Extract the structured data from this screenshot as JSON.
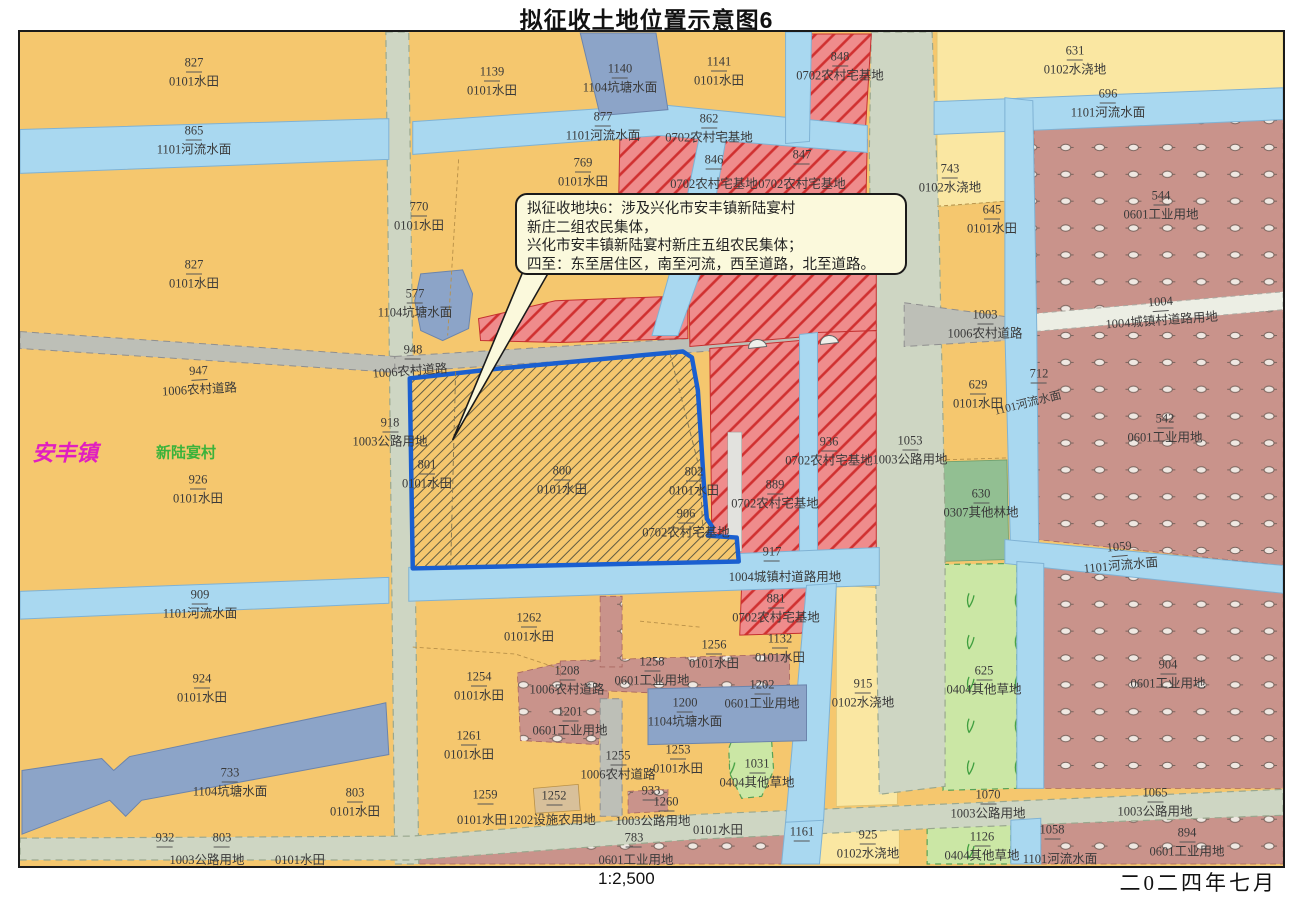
{
  "title": "拟征收土地位置示意图6",
  "scale_label": "1:2,500",
  "date_label": "二0二四年七月",
  "callout": {
    "lines": [
      "拟征收地块6：涉及兴化市安丰镇新陆宴村",
      "新庄二组农民集体，",
      "兴化市安丰镇新陆宴村新庄五组农民集体；",
      "四至：东至居住区，南至河流，西至道路，北至道路。"
    ]
  },
  "palette": {
    "paddy_0101": "#F5C76E",
    "irrigated_0102": "#FAE7A2",
    "river_1101": "#A9D8F0",
    "pond_1104": "#8CA4C8",
    "homestead_0702": "#EF8C8C",
    "homestead_hatch": "#D03030",
    "industrial_0601": "#C9938B",
    "forest_0307": "#92BF92",
    "grass_0404": "#CBE7A5",
    "road_highway_1003": "#CED6C3",
    "road_rural_1006": "#BDBFB7",
    "road_town_1004": "#ECEEE4",
    "facility_1202": "#D8C09A",
    "acquisition_outline": "#1A5FD0",
    "town_label": "#E11FC0",
    "village_label": "#3BB33B",
    "callout_bg": "#FBF9DC"
  },
  "map": {
    "labels": [
      {
        "x": 192,
        "y": 70,
        "n": "827",
        "t": "0101水田"
      },
      {
        "x": 192,
        "y": 138,
        "n": "865",
        "t": "1101河流水面"
      },
      {
        "x": 192,
        "y": 272,
        "n": "827",
        "t": "0101水田"
      },
      {
        "x": 197,
        "y": 378,
        "n": "947",
        "t": "1006农村道路",
        "r": -3
      },
      {
        "x": 63,
        "y": 452,
        "t": "安丰镇",
        "c": "#E11FC0",
        "s": 22,
        "b": 1,
        "i": 1
      },
      {
        "x": 184,
        "y": 452,
        "t": "新陆宴村",
        "c": "#3BB33B",
        "s": 15,
        "b": 1
      },
      {
        "x": 196,
        "y": 487,
        "n": "926",
        "t": "0101水田"
      },
      {
        "x": 198,
        "y": 602,
        "n": "909",
        "t": "1101河流水面"
      },
      {
        "x": 200,
        "y": 686,
        "n": "924",
        "t": "0101水田"
      },
      {
        "x": 228,
        "y": 780,
        "n": "733",
        "t": "1104坑塘水面"
      },
      {
        "x": 353,
        "y": 800,
        "n": "803",
        "t": "0101水田"
      },
      {
        "x": 163,
        "y": 838,
        "n": "932"
      },
      {
        "x": 220,
        "y": 838,
        "n": "803"
      },
      {
        "x": 205,
        "y": 858,
        "t": "1003公路用地"
      },
      {
        "x": 298,
        "y": 858,
        "t": "0101水田"
      },
      {
        "x": 490,
        "y": 79,
        "n": "1139",
        "t": "0101水田"
      },
      {
        "x": 618,
        "y": 76,
        "n": "1140",
        "t": "1104坑塘水面"
      },
      {
        "x": 601,
        "y": 124,
        "n": "877",
        "t": "1101河流水面"
      },
      {
        "x": 581,
        "y": 170,
        "n": "769",
        "t": "0101水田"
      },
      {
        "x": 417,
        "y": 214,
        "n": "770",
        "t": "0101水田"
      },
      {
        "x": 413,
        "y": 301,
        "n": "577",
        "t": "1104坑塘水面"
      },
      {
        "x": 411,
        "y": 350,
        "n": "948"
      },
      {
        "x": 408,
        "y": 369,
        "t": "1006农村道路",
        "r": -4
      },
      {
        "x": 388,
        "y": 430,
        "n": "918",
        "t": "1003公路用地"
      },
      {
        "x": 425,
        "y": 472,
        "n": "801",
        "t": "0101水田"
      },
      {
        "x": 560,
        "y": 478,
        "n": "800",
        "t": "0101水田"
      },
      {
        "x": 692,
        "y": 479,
        "n": "802",
        "t": "0101水田"
      },
      {
        "x": 684,
        "y": 521,
        "n": "906",
        "t": "0702农村宅基地"
      },
      {
        "x": 717,
        "y": 69,
        "n": "1141",
        "t": "0101水田"
      },
      {
        "x": 838,
        "y": 64,
        "n": "848",
        "t": "0702农村宅基地"
      },
      {
        "x": 707,
        "y": 126,
        "n": "862",
        "t": "0702农村宅基地"
      },
      {
        "x": 712,
        "y": 160,
        "n": "846"
      },
      {
        "x": 800,
        "y": 155,
        "n": "847"
      },
      {
        "x": 712,
        "y": 182,
        "t": "0702农村宅基地"
      },
      {
        "x": 800,
        "y": 182,
        "t": "0702农村宅基地"
      },
      {
        "x": 948,
        "y": 176,
        "n": "743",
        "t": "0102水浇地"
      },
      {
        "x": 990,
        "y": 217,
        "n": "645",
        "t": "0101水田"
      },
      {
        "x": 1073,
        "y": 58,
        "n": "631",
        "t": "0102水浇地"
      },
      {
        "x": 1106,
        "y": 101,
        "n": "696",
        "t": "1101河流水面"
      },
      {
        "x": 1159,
        "y": 203,
        "n": "544",
        "t": "0601工业用地"
      },
      {
        "x": 1159,
        "y": 309,
        "n": "1004",
        "t": "1004城镇村道路用地",
        "r": -4
      },
      {
        "x": 1163,
        "y": 426,
        "n": "542",
        "t": "0601工业用地"
      },
      {
        "x": 1037,
        "y": 374,
        "n": "712"
      },
      {
        "x": 1026,
        "y": 402,
        "t": "1101河流水面",
        "r": -14,
        "s": 11.5
      },
      {
        "x": 983,
        "y": 322,
        "n": "1003",
        "t": "1006农村道路"
      },
      {
        "x": 976,
        "y": 392,
        "n": "629",
        "t": "0101水田"
      },
      {
        "x": 979,
        "y": 501,
        "n": "630",
        "t": "0307其他林地"
      },
      {
        "x": 908,
        "y": 448,
        "n": "1053",
        "t": "1003公路用地"
      },
      {
        "x": 827,
        "y": 449,
        "n": "936",
        "t": "0702农村宅基地"
      },
      {
        "x": 773,
        "y": 492,
        "n": "889",
        "t": "0702农村宅基地"
      },
      {
        "x": 770,
        "y": 552,
        "n": "917"
      },
      {
        "x": 783,
        "y": 575,
        "t": "1004城镇村道路用地"
      },
      {
        "x": 774,
        "y": 606,
        "n": "881",
        "t": "0702农村宅基地"
      },
      {
        "x": 778,
        "y": 646,
        "n": "1132",
        "t": "0101水田"
      },
      {
        "x": 861,
        "y": 691,
        "n": "915",
        "t": "0102水浇地"
      },
      {
        "x": 1118,
        "y": 554,
        "n": "1059",
        "t": "1101河流水面",
        "r": -5
      },
      {
        "x": 1166,
        "y": 672,
        "n": "904",
        "t": "0601工业用地"
      },
      {
        "x": 982,
        "y": 678,
        "n": "625",
        "t": "0404其他草地"
      },
      {
        "x": 986,
        "y": 802,
        "n": "1070",
        "t": "1003公路用地"
      },
      {
        "x": 1153,
        "y": 800,
        "n": "1065",
        "t": "1003公路用地"
      },
      {
        "x": 980,
        "y": 844,
        "n": "1126",
        "t": "0404其他草地"
      },
      {
        "x": 1050,
        "y": 830,
        "n": "1058"
      },
      {
        "x": 1058,
        "y": 857,
        "t": "1101河流水面"
      },
      {
        "x": 1185,
        "y": 840,
        "n": "894",
        "t": "0601工业用地"
      },
      {
        "x": 527,
        "y": 625,
        "n": "1262",
        "t": "0101水田"
      },
      {
        "x": 650,
        "y": 669,
        "n": "1258",
        "t": "0601工业用地"
      },
      {
        "x": 712,
        "y": 652,
        "n": "1256",
        "t": "0101水田"
      },
      {
        "x": 565,
        "y": 678,
        "n": "1208",
        "t": "1006农村道路"
      },
      {
        "x": 568,
        "y": 719,
        "n": "1201",
        "t": "0601工业用地"
      },
      {
        "x": 477,
        "y": 684,
        "n": "1254",
        "t": "0101水田"
      },
      {
        "x": 467,
        "y": 743,
        "n": "1261",
        "t": "0101水田"
      },
      {
        "x": 683,
        "y": 710,
        "n": "1200",
        "t": "1104坑塘水面"
      },
      {
        "x": 616,
        "y": 763,
        "n": "1255",
        "t": "1006农村道路"
      },
      {
        "x": 676,
        "y": 757,
        "n": "1253",
        "t": "0101水田"
      },
      {
        "x": 760,
        "y": 692,
        "n": "1202",
        "t": "0601工业用地"
      },
      {
        "x": 755,
        "y": 771,
        "n": "1031",
        "t": "0404其他草地"
      },
      {
        "x": 483,
        "y": 795,
        "n": "1259"
      },
      {
        "x": 552,
        "y": 796,
        "n": "1252"
      },
      {
        "x": 480,
        "y": 818,
        "t": "0101水田"
      },
      {
        "x": 550,
        "y": 818,
        "t": "1202设施农用地"
      },
      {
        "x": 651,
        "y": 819,
        "t": "1003公路用地"
      },
      {
        "x": 649,
        "y": 791,
        "n": "933"
      },
      {
        "x": 664,
        "y": 802,
        "n": "1260"
      },
      {
        "x": 632,
        "y": 838,
        "n": "783"
      },
      {
        "x": 634,
        "y": 858,
        "t": "0601工业用地"
      },
      {
        "x": 716,
        "y": 828,
        "t": "0101水田"
      },
      {
        "x": 800,
        "y": 832,
        "n": "1161"
      },
      {
        "x": 866,
        "y": 842,
        "n": "925",
        "t": "0102水浇地"
      }
    ]
  }
}
